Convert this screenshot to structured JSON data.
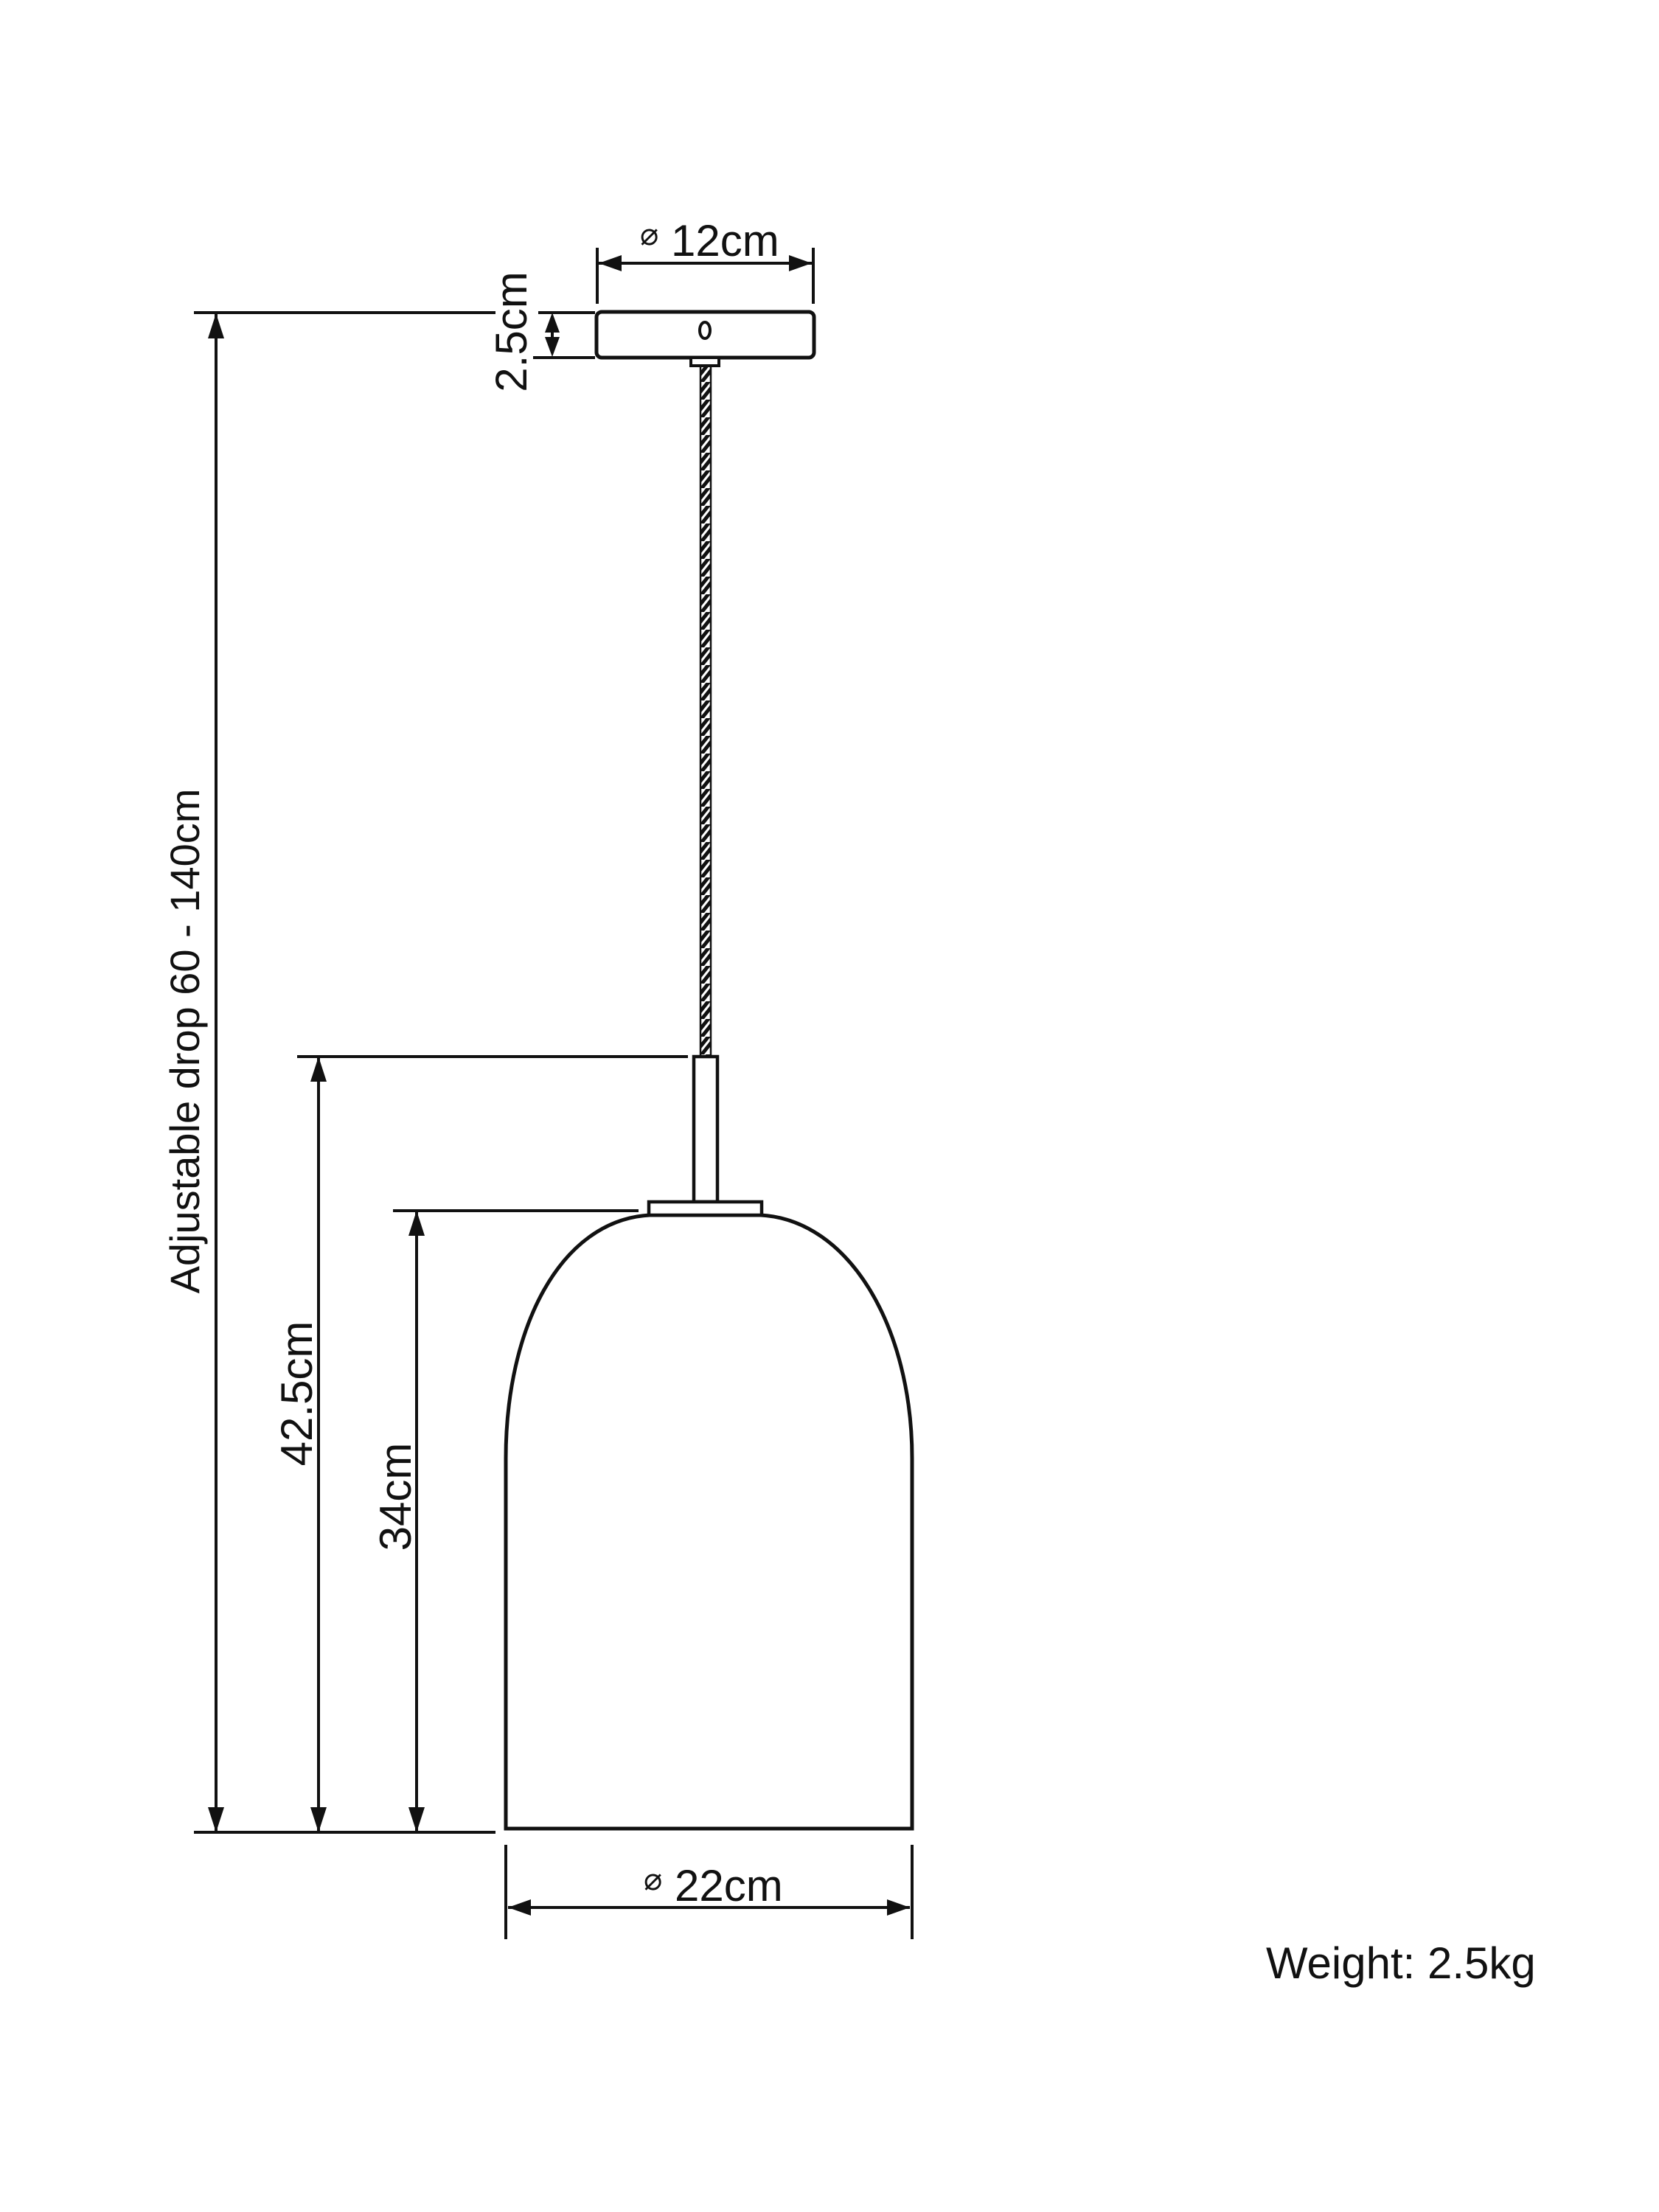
{
  "diagram": {
    "type": "pendant-light-dimension-drawing",
    "colors": {
      "line": "#111111",
      "background": "#ffffff",
      "text": "#111111"
    },
    "dimensions": {
      "adjustable_drop": {
        "label": "Adjustable drop 60 - 140cm",
        "min_cm": 60,
        "max_cm": 140
      },
      "ceiling_rose_diameter": {
        "symbol": "⌀",
        "value": "12cm",
        "cm": 12
      },
      "ceiling_rose_height": {
        "value": "2.5cm",
        "cm": 2.5
      },
      "drop_to_shade_top": {
        "value": "42.5cm",
        "cm": 42.5
      },
      "shade_height": {
        "value": "34cm",
        "cm": 34
      },
      "shade_diameter": {
        "symbol": "⌀",
        "value": "22cm",
        "cm": 22
      }
    },
    "weight": {
      "label": "Weight: 2.5kg",
      "kg": 2.5
    }
  }
}
